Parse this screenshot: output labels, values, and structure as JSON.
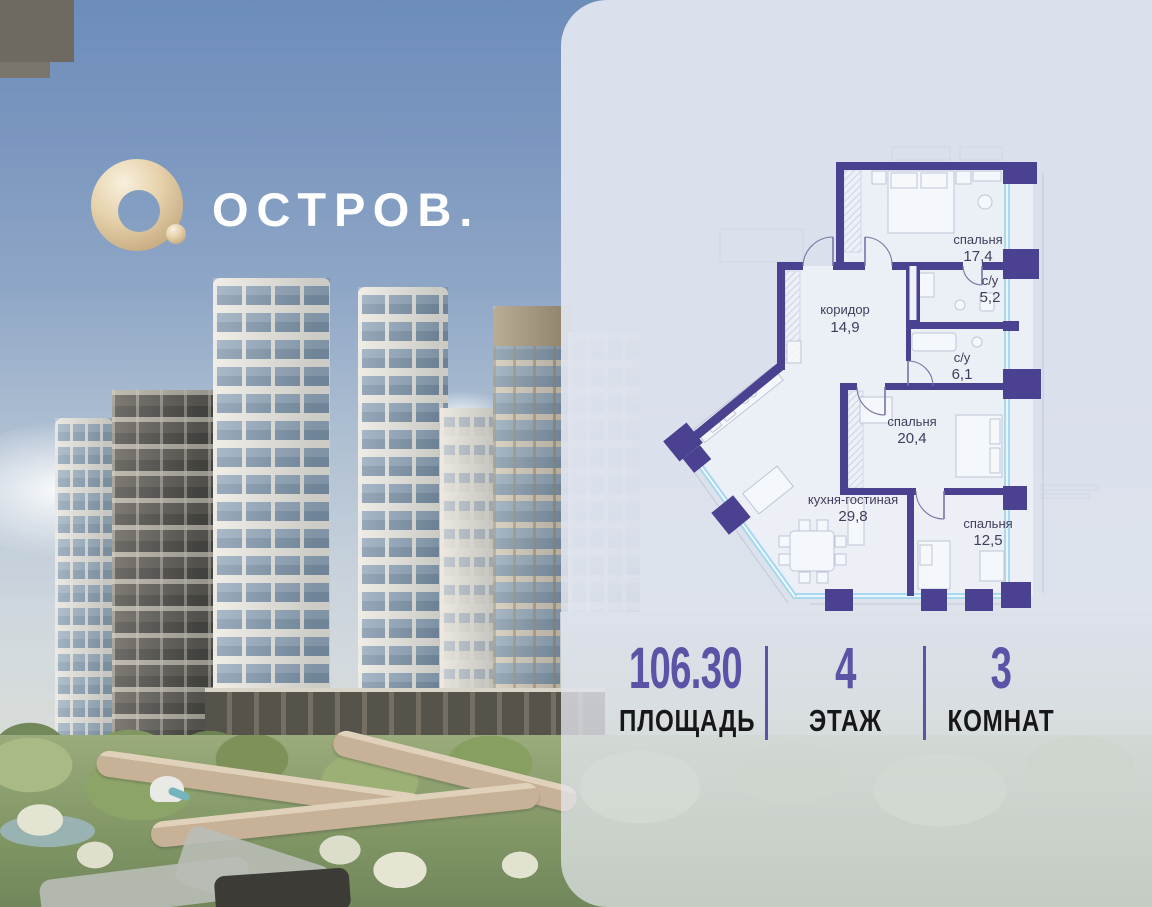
{
  "brand": {
    "name": "ОСТРОВ."
  },
  "panel": {
    "floorplan": {
      "rooms": [
        {
          "name": "спальня",
          "area": "17,4"
        },
        {
          "name": "с/у",
          "area": "5,2"
        },
        {
          "name": "коридор",
          "area": "14,9"
        },
        {
          "name": "с/у",
          "area": "6,1"
        },
        {
          "name": "спальня",
          "area": "20,4"
        },
        {
          "name": "кухня-гостиная",
          "area": "29,8"
        },
        {
          "name": "спальня",
          "area": "12,5"
        }
      ]
    },
    "stats": [
      {
        "value": "106.30",
        "label": "ПЛОЩАДЬ"
      },
      {
        "value": "4",
        "label": "ЭТАЖ"
      },
      {
        "value": "3",
        "label": "КОМНАТ"
      }
    ]
  },
  "colors": {
    "plan_wall": "#4a4190",
    "window_glazing": "#a9d9ef",
    "stat_accent": "#5b53a6",
    "logo_gold": "#dcc093",
    "panel_bg": "#dfe4ee",
    "label_text": "#413d5c"
  }
}
